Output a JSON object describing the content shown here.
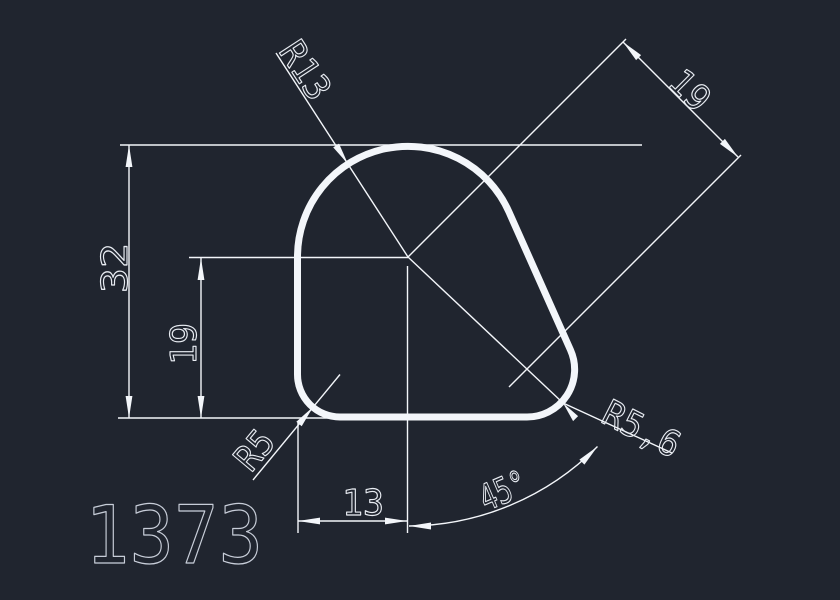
{
  "drawing": {
    "part_number": "1373",
    "labels": {
      "radius_top": "R13",
      "diagonal_distance": "19",
      "total_height": "32",
      "center_height": "19",
      "radius_bottom_left": "R5",
      "radius_bottom_right": "R5,6",
      "bottom_width": "13",
      "corner_angle": "45°"
    },
    "colors": {
      "background": "#20252f",
      "lines": "#f3f6fa",
      "text": "#e8ecf2",
      "part_number_text": "#c7cdd8"
    }
  }
}
